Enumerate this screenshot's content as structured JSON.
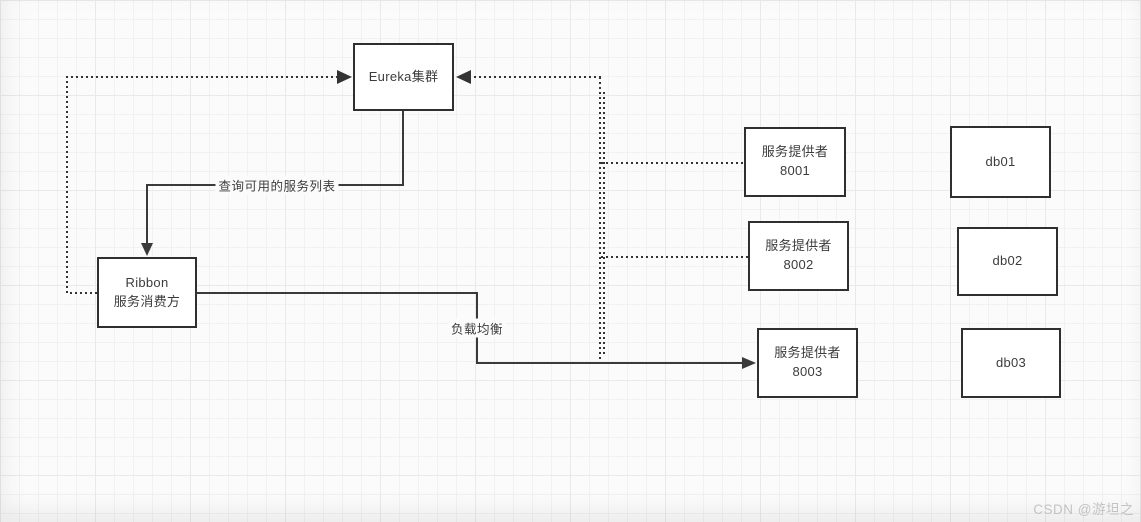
{
  "diagram": {
    "nodes": {
      "eureka": {
        "label": "Eureka集群"
      },
      "ribbon": {
        "line1": "Ribbon",
        "line2": "服务消费方"
      },
      "provider1": {
        "line1": "服务提供者",
        "line2": "8001"
      },
      "provider2": {
        "line1": "服务提供者",
        "line2": "8002"
      },
      "provider3": {
        "line1": "服务提供者",
        "line2": "8003"
      },
      "db1": {
        "label": "db01"
      },
      "db2": {
        "label": "db02"
      },
      "db3": {
        "label": "db03"
      }
    },
    "edge_labels": {
      "query_services": "查询可用的服务列表",
      "load_balance": "负载均衡"
    },
    "colors": {
      "box_border": "#2f2f2f",
      "solid_line": "#3a3a3a",
      "dotted_line": "#333333",
      "text": "#3c3c3c",
      "grid_line": "#e9e9e9",
      "background": "#fbfbfb",
      "watermark": "#c3c3c3"
    }
  },
  "watermark": {
    "text": "CSDN @游坦之"
  }
}
